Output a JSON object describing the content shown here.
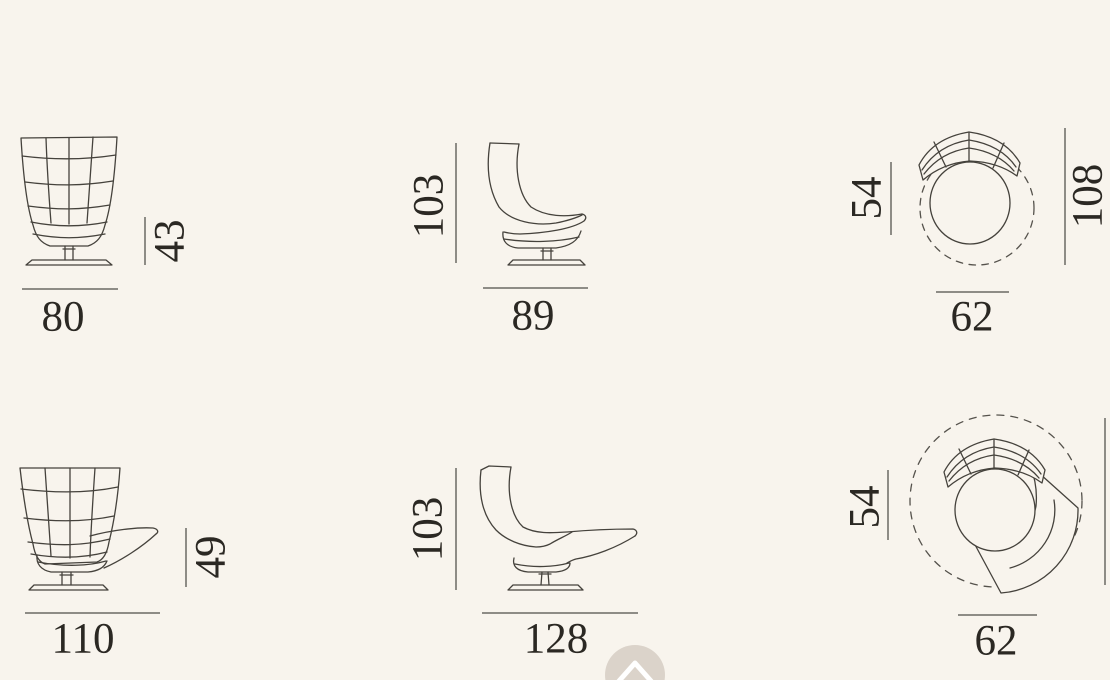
{
  "page": {
    "background_color": "#f8f4ed",
    "drawing_line_color": "#45423c",
    "dimension_line_color": "#8e8c86",
    "label_text_color": "#2b2823"
  },
  "figures": {
    "armchair_front": {
      "width": "80",
      "height": "43"
    },
    "armchair_side": {
      "width": "89",
      "height": "103"
    },
    "armchair_top": {
      "width": "62",
      "depth": "54",
      "height": "108"
    },
    "chaise_front": {
      "width": "110",
      "height": "49"
    },
    "chaise_side": {
      "width": "128",
      "height": "103"
    },
    "chaise_top": {
      "width": "62",
      "depth": "54"
    }
  },
  "scroll_top_button": {
    "icon": "chevron-up"
  }
}
